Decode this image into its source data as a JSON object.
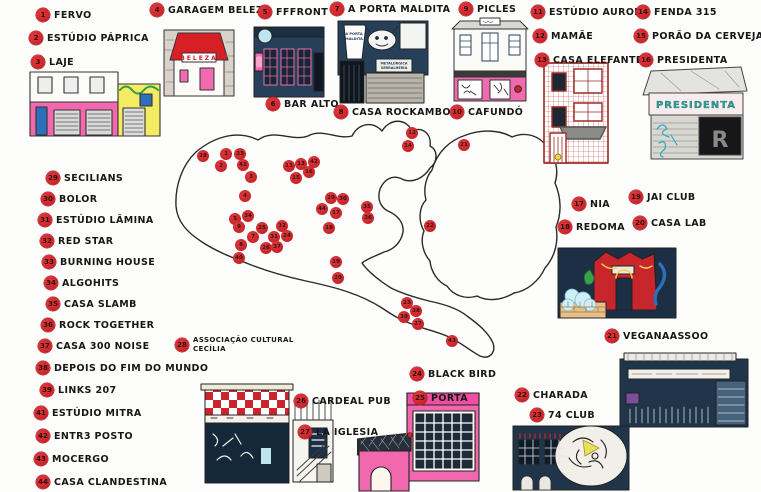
{
  "legend": {
    "items": [
      {
        "num": "1",
        "label": "FERVO",
        "x": 36,
        "y": 8
      },
      {
        "num": "2",
        "label": "ESTÚDIO PÁPRICA",
        "x": 29,
        "y": 31
      },
      {
        "num": "3",
        "label": "LAJE",
        "x": 31,
        "y": 55
      },
      {
        "num": "4",
        "label": "GARAGEM BELEZA",
        "x": 150,
        "y": 3
      },
      {
        "num": "5",
        "label": "FFFRONT",
        "x": 258,
        "y": 5
      },
      {
        "num": "6",
        "label": "BAR ALTO",
        "x": 266,
        "y": 97
      },
      {
        "num": "7",
        "label": "A PORTA MALDITA",
        "x": 330,
        "y": 2
      },
      {
        "num": "8",
        "label": "CASA ROCKAMBOLE",
        "x": 334,
        "y": 105
      },
      {
        "num": "9",
        "label": "PICLES",
        "x": 459,
        "y": 2
      },
      {
        "num": "10",
        "label": "CAFUNDÓ",
        "x": 450,
        "y": 105
      },
      {
        "num": "11",
        "label": "ESTÚDIO AURORA",
        "x": 531,
        "y": 5
      },
      {
        "num": "12",
        "label": "MAMÃE",
        "x": 533,
        "y": 29
      },
      {
        "num": "13",
        "label": "CASA ELEFANTE",
        "x": 535,
        "y": 53
      },
      {
        "num": "14",
        "label": "FENDA 315",
        "x": 636,
        "y": 5
      },
      {
        "num": "15",
        "label": "PORÃO DA CERVEJA",
        "x": 634,
        "y": 29
      },
      {
        "num": "16",
        "label": "PRESIDENTA",
        "x": 639,
        "y": 53
      },
      {
        "num": "17",
        "label": "NIA",
        "x": 572,
        "y": 197
      },
      {
        "num": "18",
        "label": "REDOMA",
        "x": 558,
        "y": 220
      },
      {
        "num": "19",
        "label": "JAI CLUB",
        "x": 629,
        "y": 190
      },
      {
        "num": "20",
        "label": "CASA LAB",
        "x": 633,
        "y": 216
      },
      {
        "num": "21",
        "label": "VEGANAASSOO",
        "x": 605,
        "y": 329
      },
      {
        "num": "22",
        "label": "CHARADA",
        "x": 515,
        "y": 388
      },
      {
        "num": "23",
        "label": "74 CLUB",
        "x": 530,
        "y": 408
      },
      {
        "num": "24",
        "label": "BLACK BIRD",
        "x": 410,
        "y": 367
      },
      {
        "num": "25",
        "label": "PORTA",
        "x": 413,
        "y": 391
      },
      {
        "num": "26",
        "label": "CARDEAL PUB",
        "x": 294,
        "y": 394
      },
      {
        "num": "27",
        "label": "LA IGLESIA",
        "x": 298,
        "y": 425
      },
      {
        "num": "28",
        "label": "ASSOCIAÇÃO CULTURAL\nCECÍLIA",
        "x": 175,
        "y": 336,
        "cls": "small"
      },
      {
        "num": "29",
        "label": "SECILIANS",
        "x": 46,
        "y": 171
      },
      {
        "num": "30",
        "label": "BOLOR",
        "x": 41,
        "y": 192
      },
      {
        "num": "31",
        "label": "ESTÚDIO LÂMINA",
        "x": 38,
        "y": 213
      },
      {
        "num": "32",
        "label": "RED STAR",
        "x": 40,
        "y": 234
      },
      {
        "num": "33",
        "label": "BURNING HOUSE",
        "x": 42,
        "y": 255
      },
      {
        "num": "34",
        "label": "ALGOHITS",
        "x": 44,
        "y": 276
      },
      {
        "num": "35",
        "label": "CASA SLAMB",
        "x": 46,
        "y": 297
      },
      {
        "num": "36",
        "label": "ROCK TOGETHER",
        "x": 41,
        "y": 318
      },
      {
        "num": "37",
        "label": "CASA 300 NOISE",
        "x": 38,
        "y": 339
      },
      {
        "num": "38",
        "label": "DEPOIS DO FIM DO MUNDO",
        "x": 36,
        "y": 361
      },
      {
        "num": "39",
        "label": "LINKS 207",
        "x": 40,
        "y": 383
      },
      {
        "num": "41",
        "label": "ESTÚDIO MITRA",
        "x": 34,
        "y": 406
      },
      {
        "num": "42",
        "label": "ENTR3 POSTO",
        "x": 36,
        "y": 429
      },
      {
        "num": "43",
        "label": "MOCERGO",
        "x": 34,
        "y": 452
      },
      {
        "num": "44",
        "label": "CASA CLANDESTINA",
        "x": 36,
        "y": 475
      }
    ]
  },
  "map": {
    "labels": [
      {
        "t": "VILA\nROMANA",
        "x": 207,
        "y": 176
      },
      {
        "t": "PERDIZES",
        "x": 276,
        "y": 190
      },
      {
        "t": "STA. CECÍLIA",
        "x": 334,
        "y": 184
      },
      {
        "t": "CONSOLAÇÃO",
        "x": 300,
        "y": 206
      },
      {
        "t": "SANTANA",
        "x": 384,
        "y": 142
      },
      {
        "t": "BOM RETIRO",
        "x": 393,
        "y": 165
      },
      {
        "t": "VILA CISPER",
        "x": 492,
        "y": 155
      },
      {
        "t": "ITAQUERA",
        "x": 488,
        "y": 197
      },
      {
        "t": "ARICANDUVA",
        "x": 468,
        "y": 215
      },
      {
        "t": "BELA\nVISTA",
        "x": 350,
        "y": 224
      },
      {
        "t": "VILA\nPRUDENTE",
        "x": 397,
        "y": 228
      },
      {
        "t": "PINHEIROS",
        "x": 279,
        "y": 255
      },
      {
        "t": "VILA\nMARIANA",
        "x": 368,
        "y": 267
      },
      {
        "t": "SACOMÃ",
        "x": 397,
        "y": 289
      },
      {
        "t": "SANTO ANDRÉ",
        "x": 450,
        "y": 305
      },
      {
        "t": "MAUÁ",
        "x": 472,
        "y": 340
      }
    ],
    "markers": [
      {
        "n": "28",
        "x": 203,
        "y": 156
      },
      {
        "n": "1",
        "x": 226,
        "y": 154
      },
      {
        "n": "33",
        "x": 240,
        "y": 154
      },
      {
        "n": "2",
        "x": 221,
        "y": 166
      },
      {
        "n": "41",
        "x": 243,
        "y": 165
      },
      {
        "n": "3",
        "x": 251,
        "y": 177
      },
      {
        "n": "4",
        "x": 245,
        "y": 196
      },
      {
        "n": "11",
        "x": 289,
        "y": 166
      },
      {
        "n": "13",
        "x": 301,
        "y": 164
      },
      {
        "n": "42",
        "x": 314,
        "y": 162
      },
      {
        "n": "15",
        "x": 296,
        "y": 178
      },
      {
        "n": "16",
        "x": 309,
        "y": 172
      },
      {
        "n": "12",
        "x": 412,
        "y": 133
      },
      {
        "n": "14",
        "x": 408,
        "y": 146
      },
      {
        "n": "21",
        "x": 464,
        "y": 145
      },
      {
        "n": "22",
        "x": 430,
        "y": 226
      },
      {
        "n": "29",
        "x": 331,
        "y": 198
      },
      {
        "n": "30",
        "x": 343,
        "y": 199
      },
      {
        "n": "44",
        "x": 322,
        "y": 209
      },
      {
        "n": "17",
        "x": 336,
        "y": 213
      },
      {
        "n": "18",
        "x": 329,
        "y": 228
      },
      {
        "n": "35",
        "x": 367,
        "y": 207
      },
      {
        "n": "36",
        "x": 368,
        "y": 218
      },
      {
        "n": "5",
        "x": 235,
        "y": 219
      },
      {
        "n": "34",
        "x": 248,
        "y": 216
      },
      {
        "n": "9",
        "x": 239,
        "y": 227
      },
      {
        "n": "25",
        "x": 262,
        "y": 228
      },
      {
        "n": "32",
        "x": 282,
        "y": 226
      },
      {
        "n": "7",
        "x": 253,
        "y": 237
      },
      {
        "n": "31",
        "x": 274,
        "y": 237
      },
      {
        "n": "24",
        "x": 287,
        "y": 236
      },
      {
        "n": "8",
        "x": 241,
        "y": 245
      },
      {
        "n": "26",
        "x": 266,
        "y": 248
      },
      {
        "n": "37",
        "x": 277,
        "y": 247
      },
      {
        "n": "40",
        "x": 239,
        "y": 258
      },
      {
        "n": "19",
        "x": 336,
        "y": 262
      },
      {
        "n": "20",
        "x": 338,
        "y": 278
      },
      {
        "n": "23",
        "x": 407,
        "y": 303
      },
      {
        "n": "38",
        "x": 416,
        "y": 311
      },
      {
        "n": "39",
        "x": 404,
        "y": 317
      },
      {
        "n": "27",
        "x": 418,
        "y": 324
      },
      {
        "n": "43",
        "x": 452,
        "y": 341
      }
    ]
  },
  "buildings": {
    "garagem_sign": "BELEZA",
    "porta_flag_line1": "A PORTA",
    "porta_flag_line2": "MALDITA",
    "metal_sign_line1": "METALÚRGICA",
    "metal_sign_line2": "SERRALHERIA",
    "presidenta_sign": "PRESIDENTA"
  }
}
